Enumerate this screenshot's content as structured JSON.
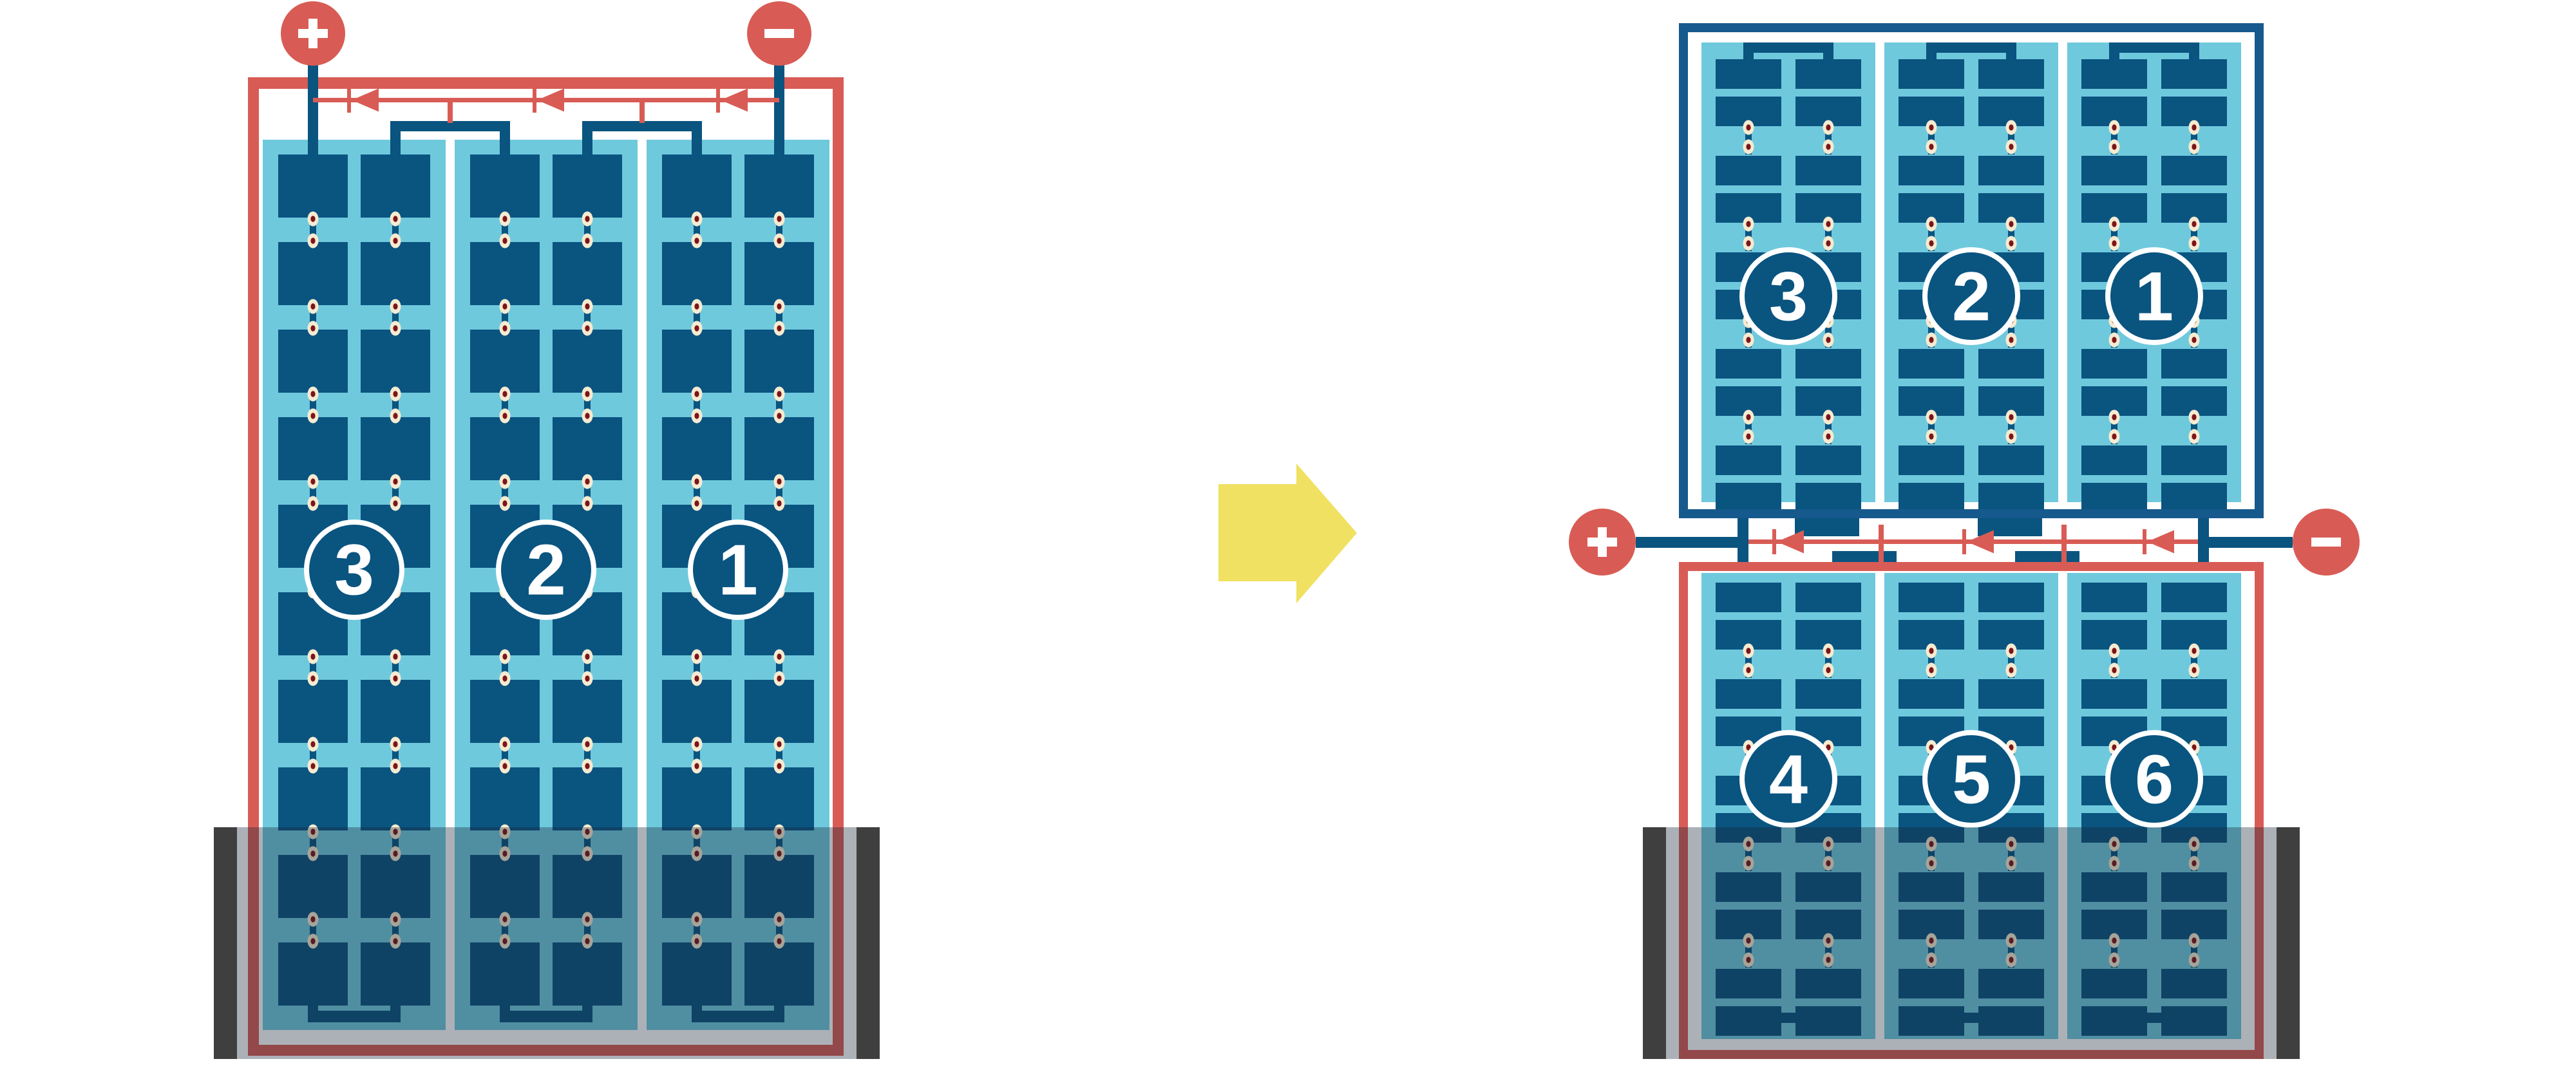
{
  "colors": {
    "background": "#ffffff",
    "red": "#d85c55",
    "navy": "#0a5480",
    "navy_frame": "#16598c",
    "light_blue": "#6fc9dd",
    "cream": "#f6ebd1",
    "dot_core": "#7d1518",
    "shadow_bar": "#3f3f3f",
    "shadow_overlay": "rgba(25,40,55,0.36)",
    "yellow": "#f0e163",
    "white": "#ffffff"
  },
  "left_module": {
    "name": "full-size module",
    "terminals": [
      {
        "sign": "+"
      },
      {
        "sign": "−"
      }
    ],
    "bypass_diode_count": 3,
    "cell_strings": [
      {
        "label": "3"
      },
      {
        "label": "2"
      },
      {
        "label": "1"
      }
    ],
    "columns_per_string": 2,
    "rows_per_string": 10,
    "shaded_region": "bottom"
  },
  "right_modules": {
    "top": {
      "name": "upper half module",
      "frame_color": "navy",
      "cell_strings": [
        {
          "label": "3"
        },
        {
          "label": "2"
        },
        {
          "label": "1"
        }
      ],
      "columns_per_string": 2,
      "rows_per_string": 10
    },
    "bottom": {
      "name": "lower half module",
      "frame_color": "red",
      "cell_strings": [
        {
          "label": "4"
        },
        {
          "label": "5"
        },
        {
          "label": "6"
        }
      ],
      "columns_per_string": 2,
      "rows_per_string": 10,
      "shaded_region": "bottom"
    },
    "terminals": [
      {
        "sign": "+"
      },
      {
        "sign": "−"
      }
    ],
    "bypass_diode_count": 3
  },
  "arrow": {
    "direction": "right"
  }
}
